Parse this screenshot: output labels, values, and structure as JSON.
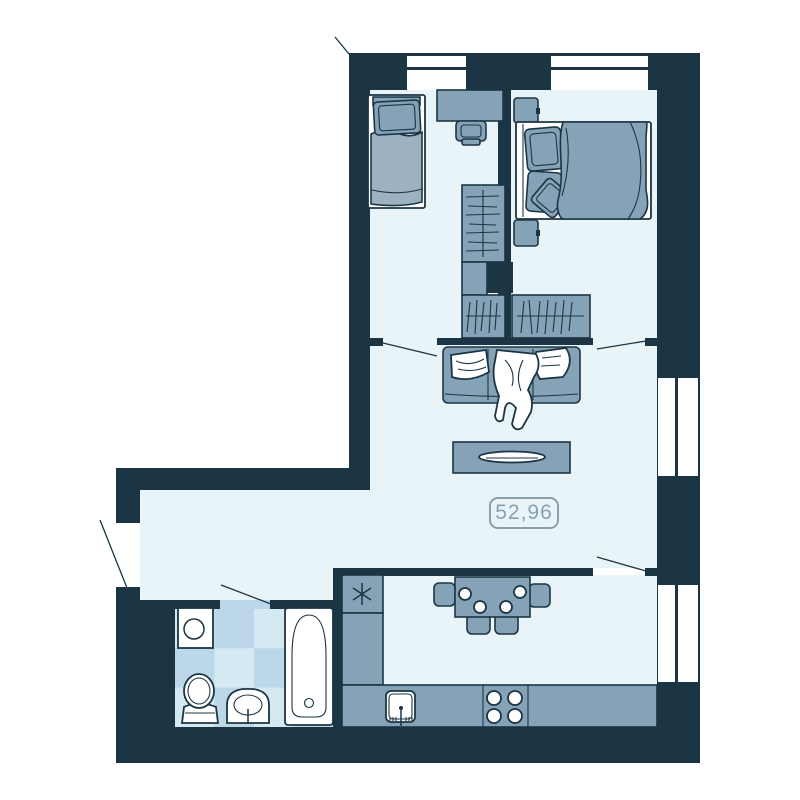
{
  "plan": {
    "title": "apartment-floor-plan",
    "area_label": "52,96"
  },
  "colors": {
    "wall": "#1b3544",
    "furniture": "#85a2b6",
    "furniture_light": "#9db2c1",
    "floor": "#e9f4f9",
    "tile_light": "#d5e9f3",
    "tile_dark": "#bcd8e8",
    "outline": "#1b3544",
    "label": "#8aa0ad",
    "window": "#ffffff"
  },
  "furniture_icons": [
    "single-bed-icon",
    "desk-icon",
    "desk-chair-icon",
    "wardrobe-rail-icon",
    "wardrobe-hangers-left-icon",
    "wardrobe-hangers-right-icon",
    "double-bed-icon",
    "nightstand-icon",
    "sofa-icon",
    "coffee-table-icon",
    "dining-table-icon",
    "dining-chair-icon",
    "kitchen-counter-icon",
    "kitchen-sink-icon",
    "stove-icon",
    "vent-asterisk-icon",
    "bathtub-icon",
    "toilet-icon",
    "bathroom-sink-icon",
    "washing-machine-icon",
    "window-icon",
    "door-swing-icon"
  ]
}
